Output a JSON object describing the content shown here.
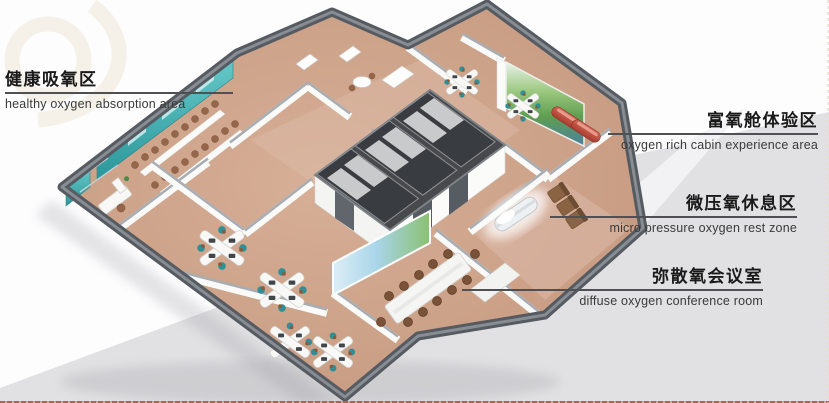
{
  "labels": [
    {
      "zh": "健康吸氧区",
      "en": "healthy oxygen absorption area"
    },
    {
      "zh": "富氧舱体验区",
      "en": "oxygen rich cabin experience area"
    },
    {
      "zh": "微压氧休息区",
      "en": "micro pressure oxygen rest zone"
    },
    {
      "zh": "弥散氧会议室",
      "en": "diffuse oxygen conference room"
    }
  ],
  "colors": {
    "label_text": "#1a1a1a",
    "label_sub": "#3a3a3a",
    "leader_line": "#4f5054",
    "bottom_strip": "#b2604f",
    "background_gray": "#e1e1e3",
    "wall_dark": "#565b61",
    "wall_cap": "#a7adb3",
    "floor_tan": "#c9a08a",
    "teal_wall": "#3eb0b2",
    "mural_green": "#5f9e50",
    "cabin_red": "#c05244",
    "sofa_brown": "#8a6343",
    "chair_teal": "#2f8f96"
  }
}
